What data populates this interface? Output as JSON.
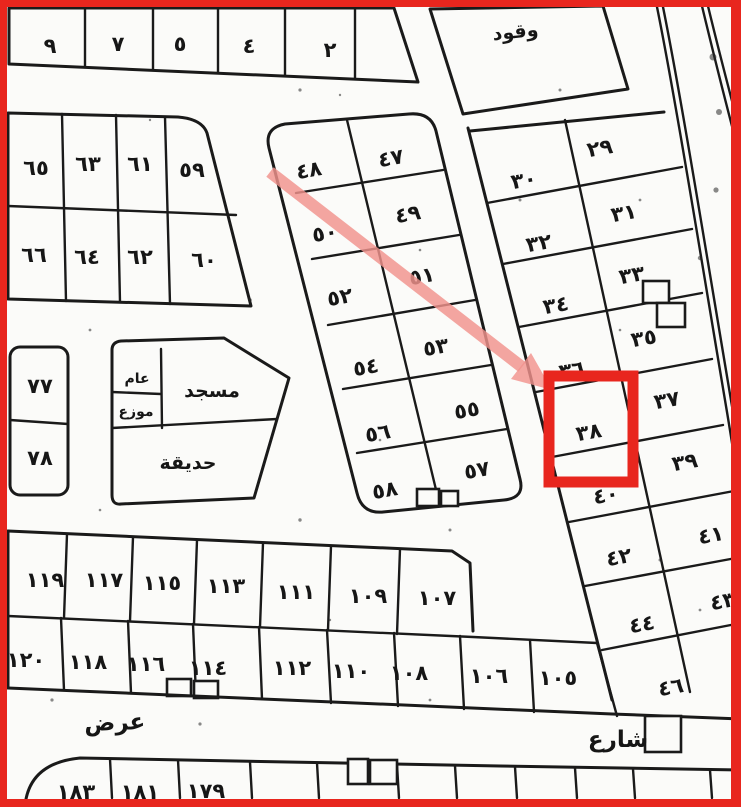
{
  "map_title": "cadastral-plot-map",
  "blocks": {
    "top_row": [
      "٩",
      "٧",
      "٥",
      "٤",
      "٢"
    ],
    "fuel": "وقود",
    "left_rows": [
      [
        "٦٥",
        "٦٣",
        "٦١",
        "٥٩"
      ],
      [
        "٦٦",
        "٦٤",
        "٦٢",
        "٦٠"
      ]
    ],
    "middle_rows": [
      [
        "٤٨",
        "٤٧"
      ],
      [
        "٥٠",
        "٤٩"
      ],
      [
        "٥٢",
        "٥١"
      ],
      [
        "٥٤",
        "٥٣"
      ],
      [
        "٥٦",
        "٥٥"
      ],
      [
        "٥٨",
        "٥٧"
      ]
    ],
    "right_left_col": [
      "٣٠",
      "٣٢",
      "٣٤",
      "٣٦",
      "٣٨",
      "٤٠",
      "٤٢",
      "٤٤",
      "٤٦"
    ],
    "right_right_col": [
      "٢٩",
      "٣١",
      "٣٣",
      "٣٥",
      "٣٧",
      "٣٩",
      "٤١",
      "٤٣"
    ],
    "pair_west": [
      "٧٧",
      "٧٨"
    ],
    "mosque_block": {
      "mosque": "مسجد",
      "garden": "حديقة",
      "small_top": "عام",
      "small_bottom": "موزع"
    },
    "south_rows": [
      [
        "١١٩",
        "١١٧",
        "١١٥",
        "١١٣",
        "١١١",
        "١٠٩",
        "١٠٧"
      ],
      [
        "١٢٠",
        "١١٨",
        "١١٦",
        "١١٤",
        "١١٢",
        "١١٠",
        "١٠٨",
        "١٠٦",
        "١٠٥"
      ]
    ],
    "streets": {
      "west": "عرض",
      "south": "شارع"
    },
    "edge_row": [
      "١٨٣",
      "١٨١",
      "١٧٩"
    ]
  },
  "annotation": {
    "highlighted_plot": "٣٨",
    "border_color": "#e8261e",
    "box_color": "#e8261e",
    "arrow_color": "#f2938d"
  }
}
